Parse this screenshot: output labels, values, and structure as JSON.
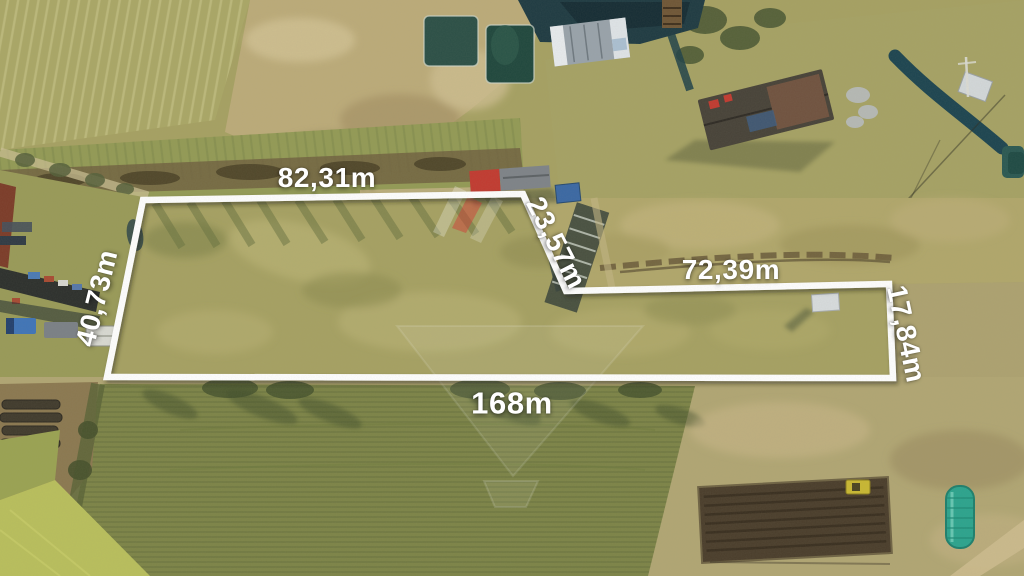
{
  "photo": {
    "kind": "aerial-drone-photo-of-land-plot",
    "plot_outline_present": true
  },
  "palette": {
    "outline": "#ffffff",
    "labelColor": "#ffffff",
    "grassMain": "#a6a162",
    "grassLight": "#bdb678",
    "fieldBottom": "#7d8447",
    "dirtTan": "#bcab79",
    "waterDark": "#1e3a42",
    "pondGreen": "#2b4f46",
    "shedRed": "#c23a30",
    "roofDark": "#474238",
    "blueShed": "#3a68a4",
    "carBlue": "#3f74b8",
    "greenhouseTeal": "#2ba48e",
    "tractorYellow": "#c9b832"
  },
  "plot": {
    "measurements": [
      {
        "side": "top-edge",
        "label": "82,31m"
      },
      {
        "side": "diagonal-edge",
        "label": "23,57m"
      },
      {
        "side": "upper-right-edge",
        "label": "72,39m"
      },
      {
        "side": "right-edge",
        "label": "17,84m"
      },
      {
        "side": "left-edge",
        "label": "40,73m"
      },
      {
        "side": "bottom-edge",
        "label": "168m"
      }
    ]
  },
  "scene": {
    "features": [
      {
        "name": "lake"
      },
      {
        "name": "fish-ponds"
      },
      {
        "name": "construction-building"
      },
      {
        "name": "farm-house"
      },
      {
        "name": "red-roof-shed"
      },
      {
        "name": "gray-shed"
      },
      {
        "name": "blue-shed"
      },
      {
        "name": "white-shed"
      },
      {
        "name": "stream"
      },
      {
        "name": "blue-car"
      },
      {
        "name": "farm-vehicles"
      },
      {
        "name": "wood-piles"
      },
      {
        "name": "plowed-garden"
      },
      {
        "name": "greenhouse-tunnel"
      },
      {
        "name": "yellow-tractor"
      },
      {
        "name": "dirt-paths"
      },
      {
        "name": "crop-field"
      },
      {
        "name": "watermark-emblem"
      }
    ]
  }
}
